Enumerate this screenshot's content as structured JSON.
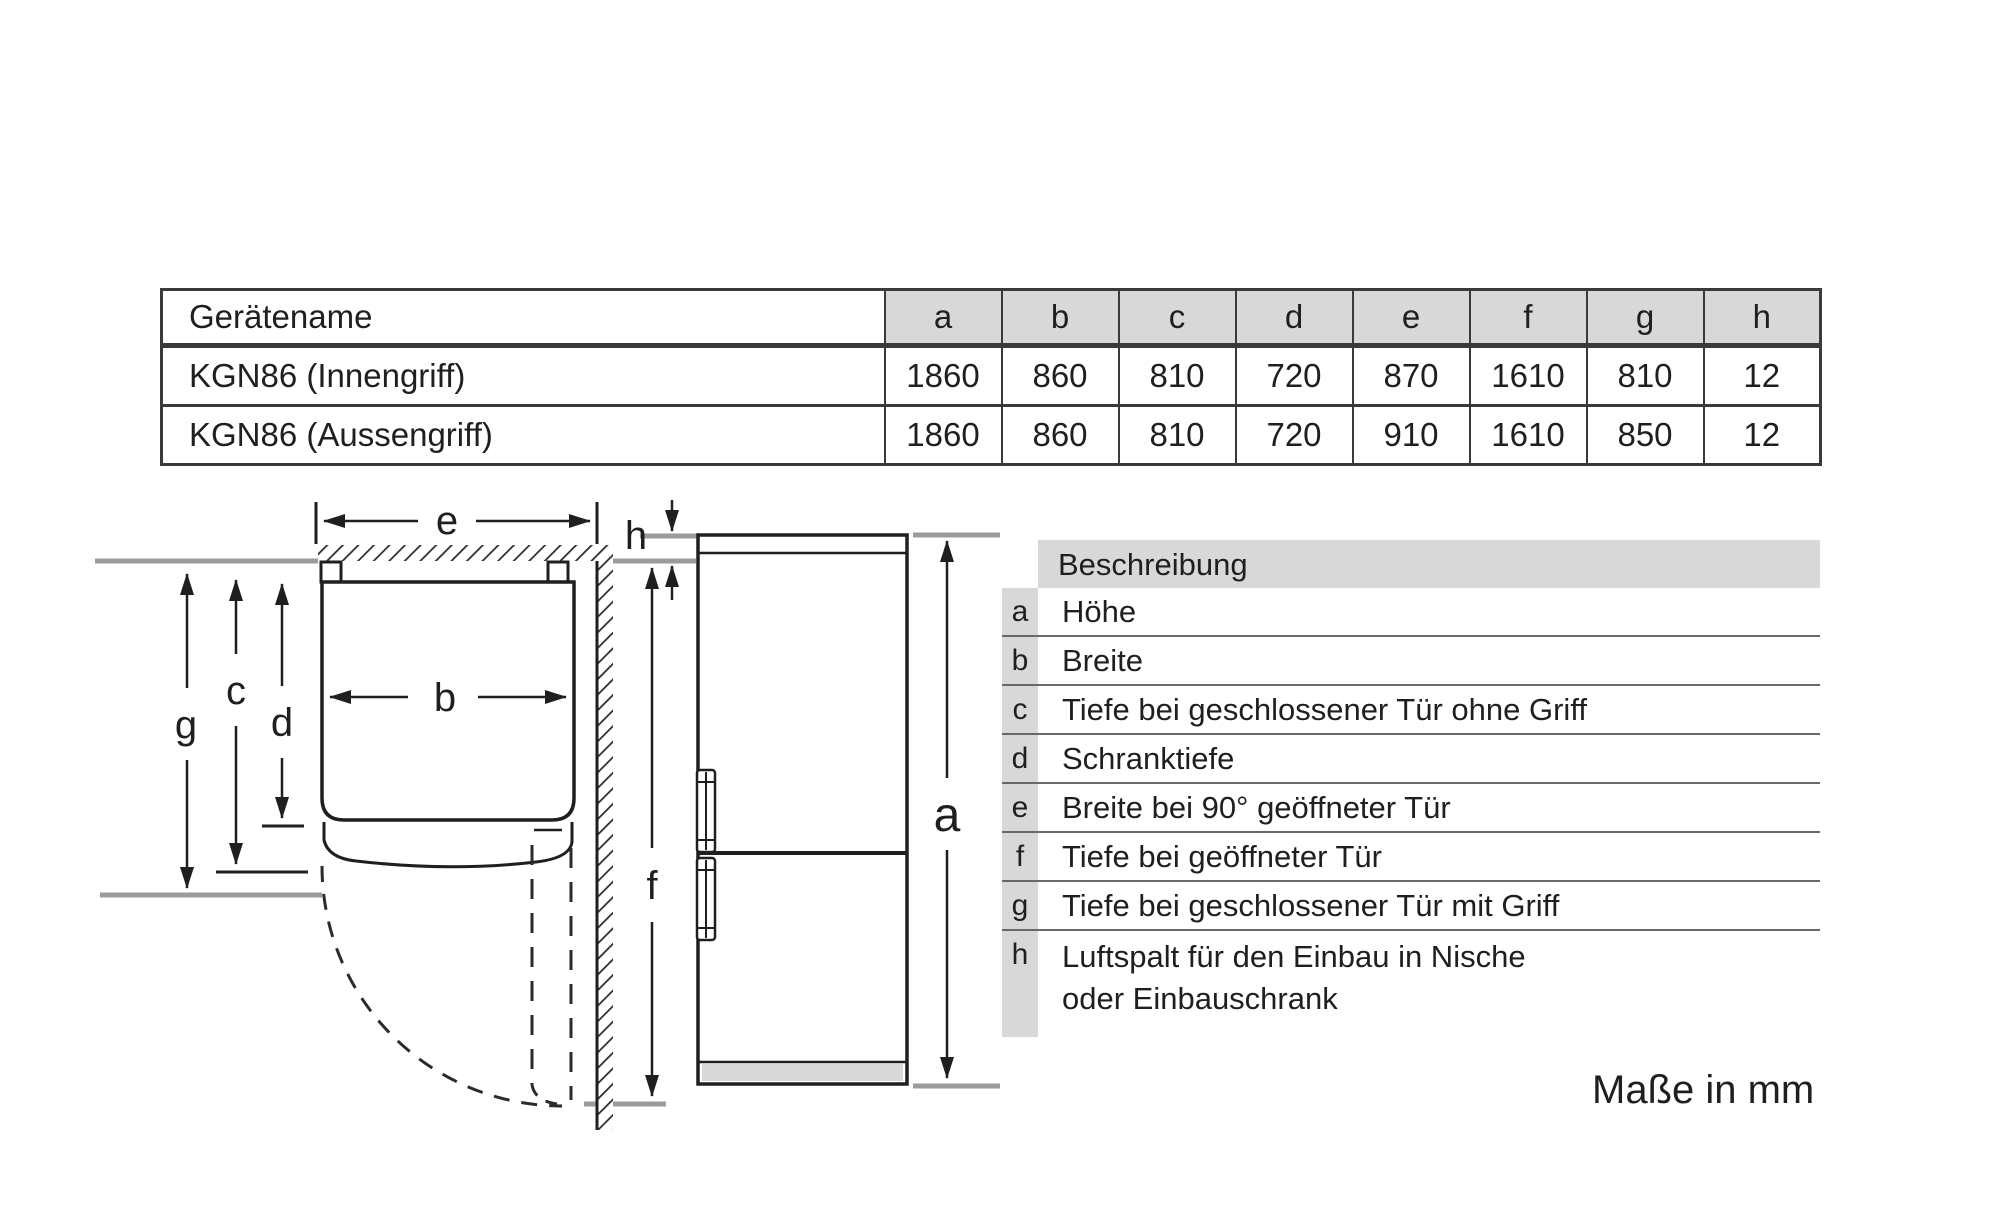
{
  "spec_table": {
    "name_header": "Gerätename",
    "dim_headers": [
      "a",
      "b",
      "c",
      "d",
      "e",
      "f",
      "g",
      "h"
    ],
    "rows": [
      {
        "name": "KGN86 (Innengriff)",
        "values": [
          "1860",
          "860",
          "810",
          "720",
          "870",
          "1610",
          "810",
          "12"
        ]
      },
      {
        "name": "KGN86 (Aussengriff)",
        "values": [
          "1860",
          "860",
          "810",
          "720",
          "910",
          "1610",
          "850",
          "12"
        ]
      }
    ]
  },
  "legend": {
    "header": "Beschreibung",
    "rows": [
      {
        "key": "a",
        "text": "Höhe"
      },
      {
        "key": "b",
        "text": "Breite"
      },
      {
        "key": "c",
        "text": "Tiefe bei geschlossener Tür ohne Griff"
      },
      {
        "key": "d",
        "text": "Schranktiefe"
      },
      {
        "key": "e",
        "text": "Breite bei 90° geöffneter Tür"
      },
      {
        "key": "f",
        "text": "Tiefe bei geöffneter Tür"
      },
      {
        "key": "g",
        "text": "Tiefe bei geschlossener Tür mit Griff"
      },
      {
        "key": "h",
        "text": "Luftspalt für den Einbau in Nische",
        "text2": "oder Einbauschrank"
      }
    ]
  },
  "diagram": {
    "labels": {
      "a": "a",
      "b": "b",
      "c": "c",
      "d": "d",
      "e": "e",
      "f": "f",
      "g": "g",
      "h": "h"
    }
  },
  "footer": {
    "note": "Maße in mm"
  },
  "colors": {
    "header_fill": "#d8d8d8",
    "ink": "#1f1f1f",
    "gray_line": "#9b9b9b"
  }
}
